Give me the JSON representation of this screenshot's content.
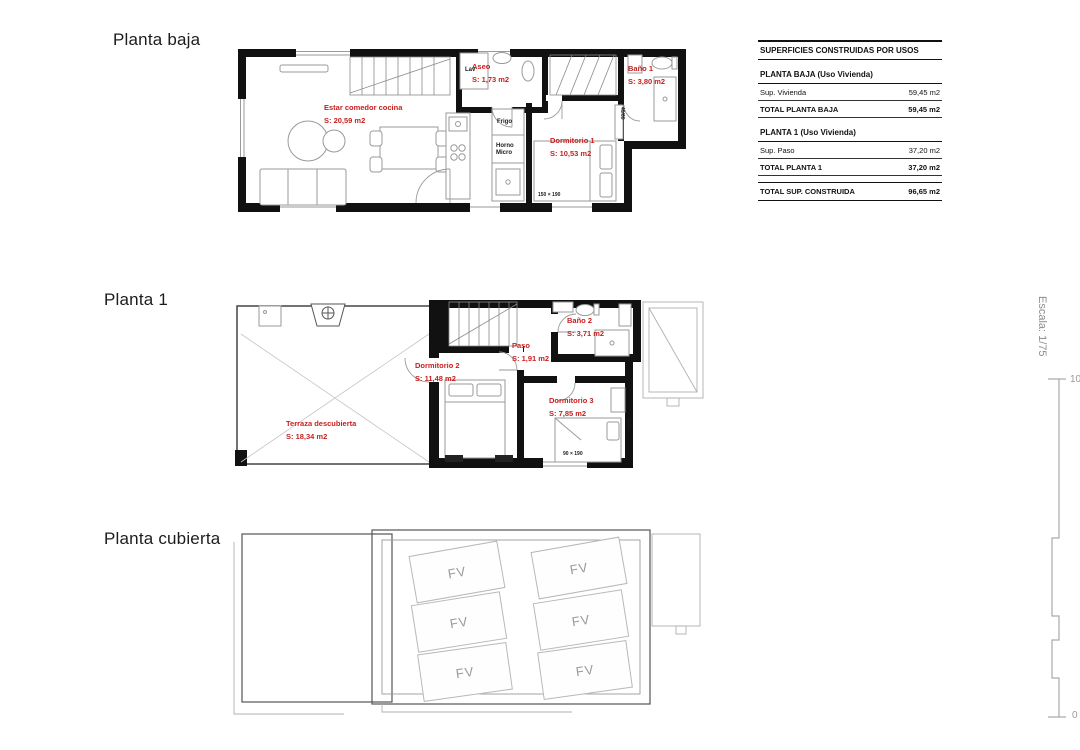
{
  "colors": {
    "label_red": "#c81e1e",
    "wall_black": "#111111",
    "furniture_gray": "#9a9a9a",
    "outline_light_gray": "#b8b8b8"
  },
  "planta_baja": {
    "heading": "Planta baja",
    "rooms": {
      "estar": {
        "name": "Estar comedor cocina",
        "area": "S: 20,59 m2"
      },
      "aseo": {
        "name": "Aseo",
        "area": "S: 1,73 m2"
      },
      "bano1": {
        "name": "Baño 1",
        "area": "S: 3,80 m2"
      },
      "dorm1": {
        "name": "Dormitorio 1",
        "area": "S: 10,53 m2"
      }
    },
    "labels": {
      "lav": "Lav",
      "frigo": "Frigo",
      "horno": "Horno",
      "micro": "Micro",
      "bed1_size": "150 × 190",
      "closet": "40/60"
    }
  },
  "planta_1": {
    "heading": "Planta 1",
    "rooms": {
      "terraza": {
        "name": "Terraza descubierta",
        "area": "S: 18,34 m2"
      },
      "dorm2": {
        "name": "Dormitorio 2",
        "area": "S: 11,48 m2"
      },
      "paso": {
        "name": "Paso",
        "area": "S: 1,91 m2"
      },
      "bano2": {
        "name": "Baño 2",
        "area": "S: 3,71 m2"
      },
      "dorm3": {
        "name": "Dormitorio 3",
        "area": "S: 7,85 m2"
      }
    },
    "labels": {
      "bed3_size": "90 × 190",
      "closet": "40/60"
    }
  },
  "planta_cubierta": {
    "heading": "Planta cubierta",
    "panel_label": "FV"
  },
  "summary_table": {
    "title": "SUPERFICIES CONSTRUIDAS POR USOS",
    "groups": [
      {
        "header": "PLANTA BAJA (Uso Vivienda)",
        "rows": [
          {
            "label": "Sup. Vivienda",
            "value": "59,45 m2"
          }
        ],
        "total": {
          "label": "TOTAL PLANTA BAJA",
          "value": "59,45 m2"
        }
      },
      {
        "header": "PLANTA 1 (Uso Vivienda)",
        "rows": [
          {
            "label": "Sup. Paso",
            "value": "37,20 m2"
          }
        ],
        "total": {
          "label": "TOTAL PLANTA 1",
          "value": "37,20 m2"
        }
      }
    ],
    "grand_total": {
      "label": "TOTAL SUP. CONSTRUIDA",
      "value": "96,65 m2"
    }
  },
  "scale_bar": {
    "label": "Escala: 1/75",
    "max": "10",
    "min": "0"
  }
}
